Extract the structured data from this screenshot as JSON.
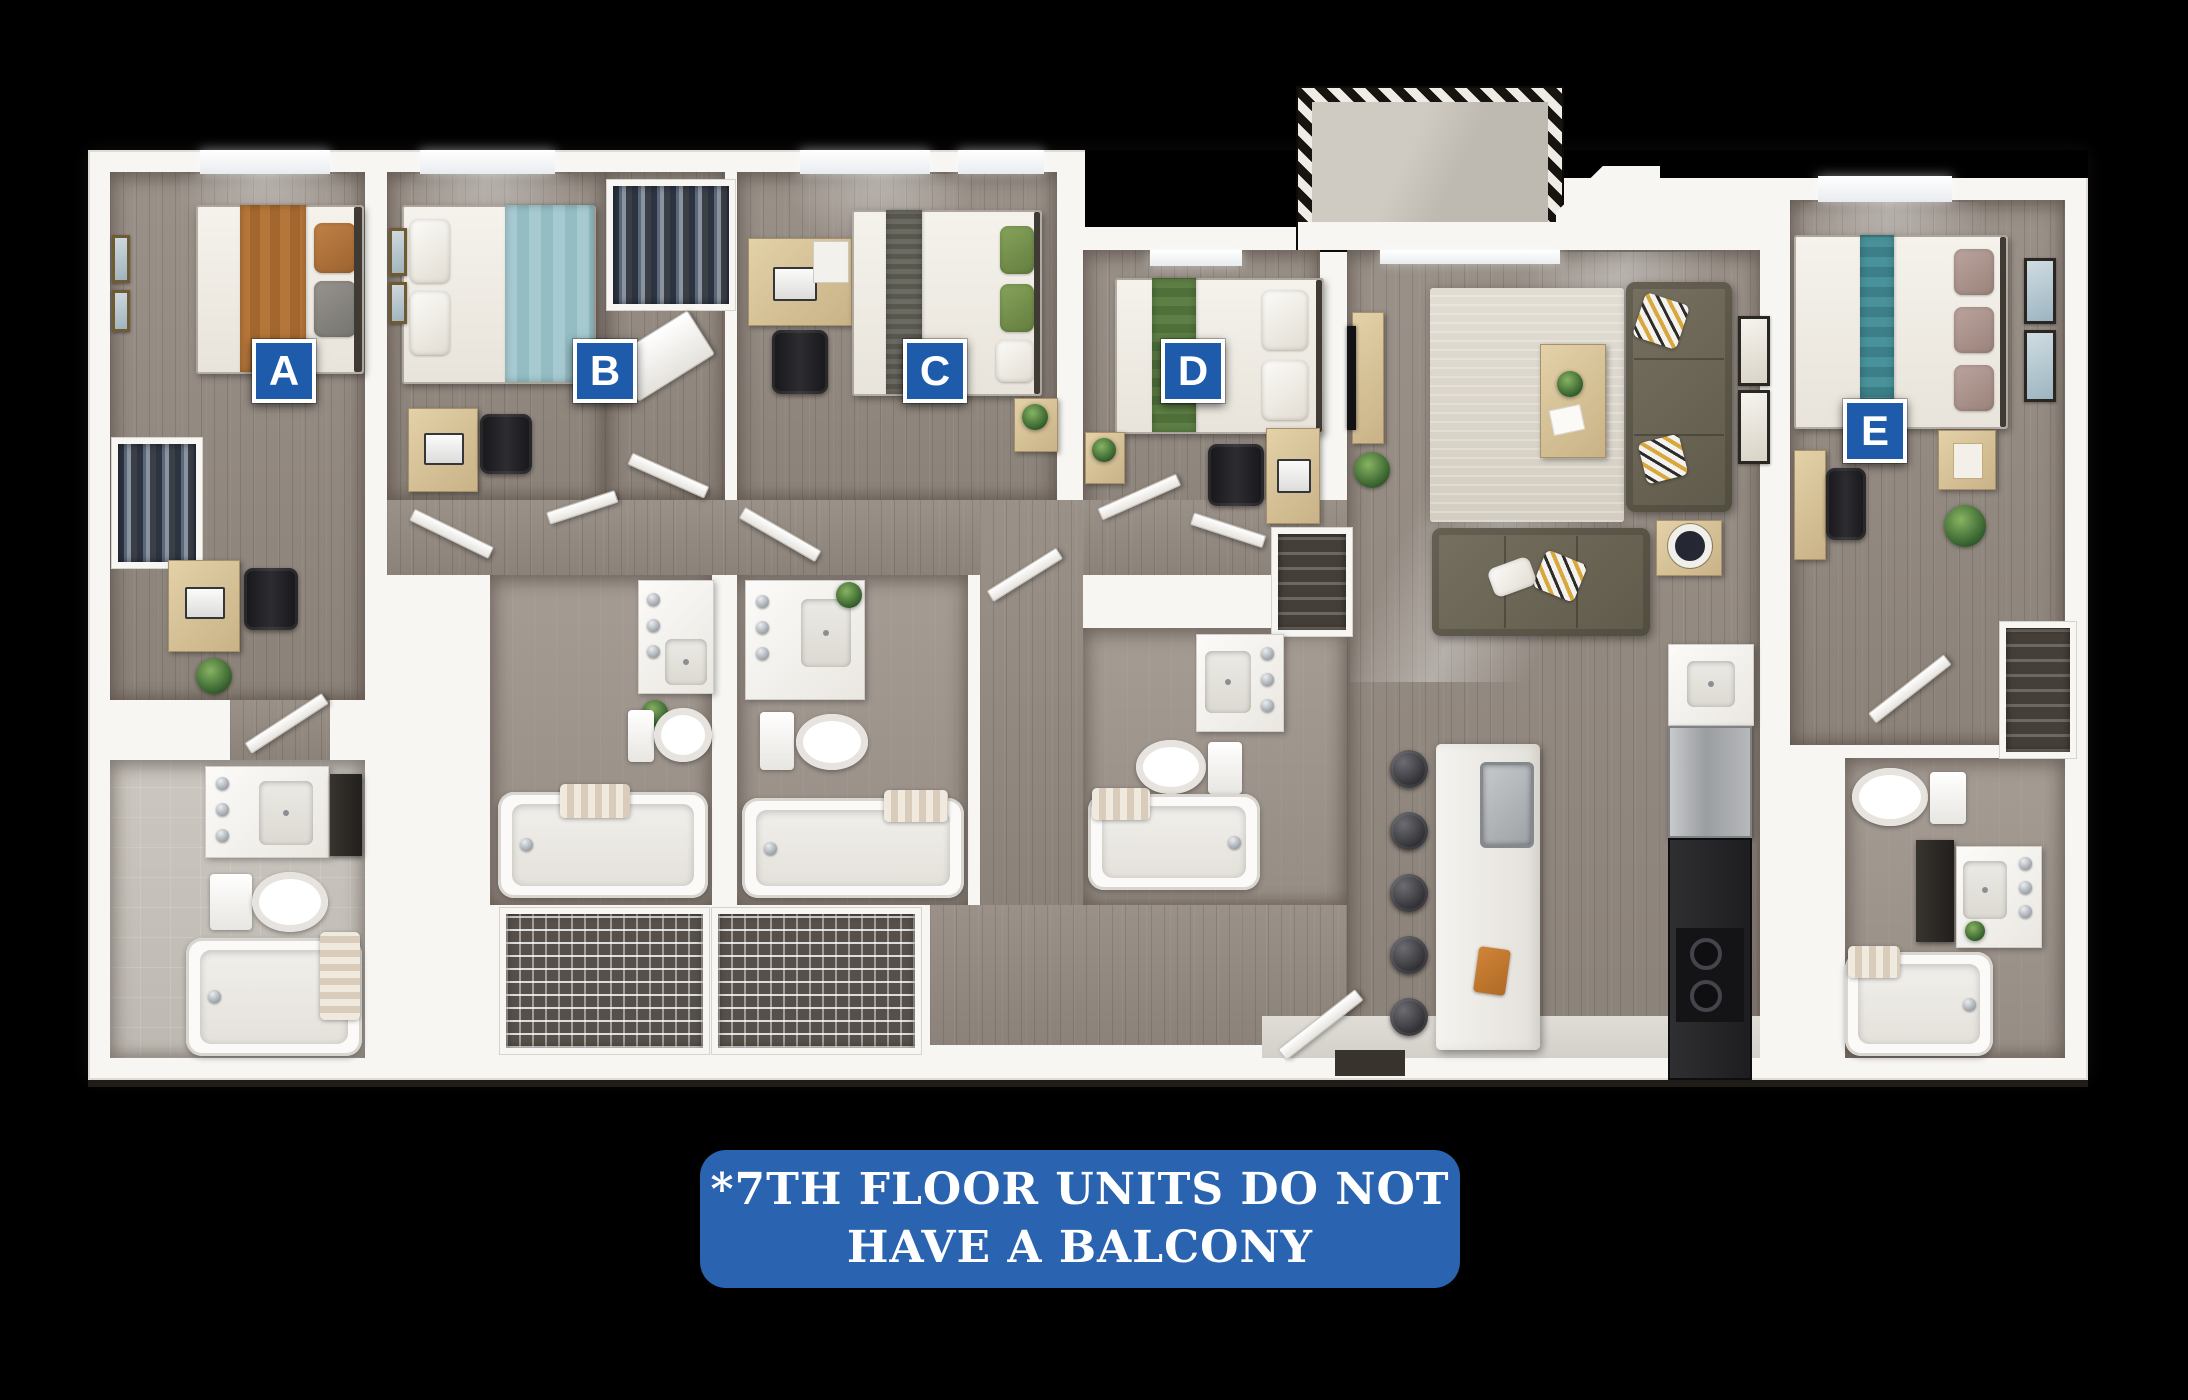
{
  "floorplan": {
    "badges": [
      {
        "letter": "A"
      },
      {
        "letter": "B"
      },
      {
        "letter": "C"
      },
      {
        "letter": "D"
      },
      {
        "letter": "E"
      }
    ],
    "colors": {
      "badge_blue": "#1e5cab",
      "banner_blue": "#2a63af",
      "wall_white": "#f7f6f3",
      "floor_wood": "#968d84",
      "background": "#000000"
    }
  },
  "note_banner": {
    "line1": "*7TH FLOOR UNITS DO NOT",
    "line2": "HAVE A BALCONY"
  }
}
